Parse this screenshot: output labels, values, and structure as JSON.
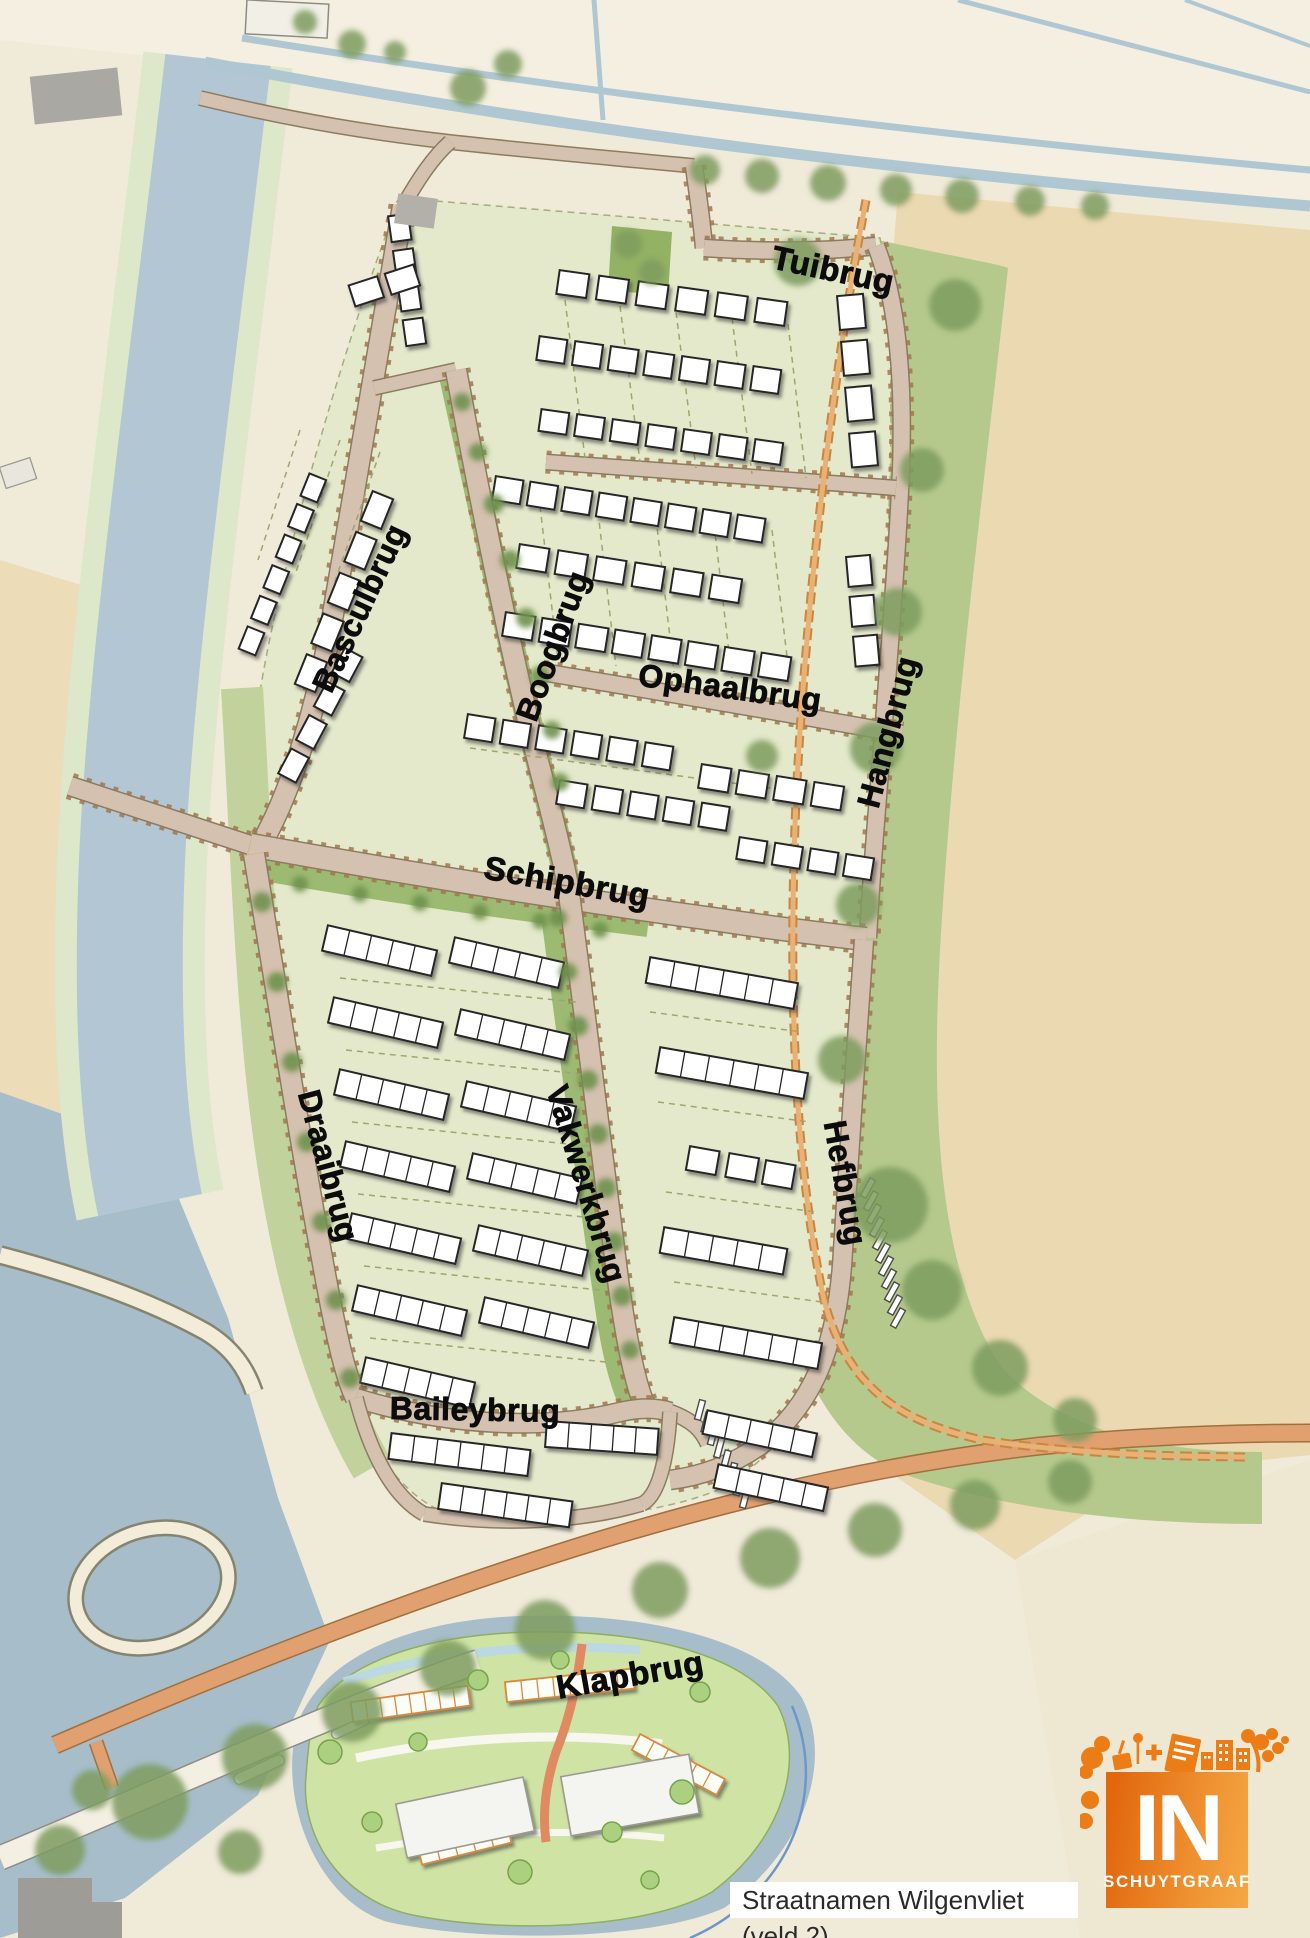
{
  "page": {
    "width": 1310,
    "height": 1938,
    "title": "Straatnamen Wilgenvliet (veld 2)"
  },
  "map": {
    "region_name": "Wilgenvliet (veld 2)",
    "street_labels": [
      {
        "name": "Tuibrug",
        "x": 833,
        "y": 270,
        "rotate": 12,
        "size": 33
      },
      {
        "name": "Basculbrug",
        "x": 360,
        "y": 608,
        "rotate": -65,
        "size": 32
      },
      {
        "name": "Boogbrug",
        "x": 553,
        "y": 646,
        "rotate": -70,
        "size": 32
      },
      {
        "name": "Ophaalbrug",
        "x": 730,
        "y": 688,
        "rotate": 8,
        "size": 32
      },
      {
        "name": "Hangbrug",
        "x": 888,
        "y": 732,
        "rotate": -75,
        "size": 32
      },
      {
        "name": "Schipbrug",
        "x": 567,
        "y": 882,
        "rotate": 10,
        "size": 33
      },
      {
        "name": "Draaibrug",
        "x": 328,
        "y": 1166,
        "rotate": 75,
        "size": 32
      },
      {
        "name": "Vakwerkbrug",
        "x": 586,
        "y": 1184,
        "rotate": 73,
        "size": 32
      },
      {
        "name": "Hefbrug",
        "x": 845,
        "y": 1183,
        "rotate": 80,
        "size": 32
      },
      {
        "name": "Baileybrug",
        "x": 475,
        "y": 1410,
        "rotate": 1,
        "size": 32
      },
      {
        "name": "Klapbrug",
        "x": 630,
        "y": 1675,
        "rotate": -10,
        "size": 33
      }
    ],
    "caption": "Straatnamen Wilgenvliet (veld 2)",
    "logo": {
      "word": "IN",
      "subtitle": "SCHUYTGRAAF",
      "orange_dark": "#e1660c",
      "orange_light": "#f5a845"
    },
    "colors": {
      "cream": "#f0ead9",
      "cream_light": "#f4efe0",
      "farmland": "#ebd9b2",
      "farmland_west": "#ecdcb8",
      "water": "#b2c7d3",
      "water_deep": "#a7bdca",
      "bank": "#dde7c9",
      "green_belt": "#b5c98c",
      "green_strip": "#9cba72",
      "block": "#e3e9ca",
      "road": "#d5c1af",
      "road_edge": "#8b7c60",
      "road_tick": "#a3764f",
      "orange_road": "#e0a070",
      "orange_path": "#e8b277",
      "white_road": "#f3efe2",
      "house": "#ffffff",
      "house_outline": "#262626",
      "tree": "#7e9c5f",
      "tree_dark": "#6f914d",
      "site_green": "#cfe4a4",
      "site_tree": "#abd07f",
      "label_color": "#0c0c0c"
    }
  }
}
